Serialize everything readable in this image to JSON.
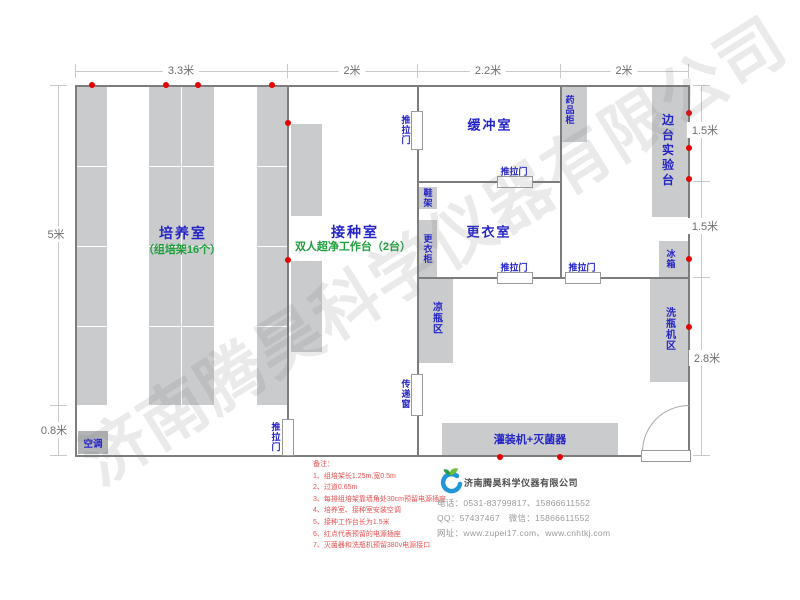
{
  "watermark": "济南腾昊科学仪器有限公司",
  "dims": {
    "top1": "3.3米",
    "top2": "2米",
    "top3": "2.2米",
    "top4": "2米",
    "left1": "5米",
    "left2": "0.8米",
    "right1": "1.5米",
    "right2": "1.5米",
    "right3": "2.8米"
  },
  "rooms": {
    "culture": "培养室",
    "culture_sub": "（组培架16个）",
    "inoculation": "接种室",
    "inoculation_sub": "双人超净工作台（2台）",
    "buffer": "缓冲室",
    "changing": "更衣室",
    "side_bench": "边台实验台"
  },
  "labels": {
    "sliding_door": "推拉门",
    "transfer_window": "传递窗",
    "ac": "空调",
    "medicine_cabinet": "药品柜",
    "shoe_rack": "鞋架",
    "wardrobe": "更衣柜",
    "fridge": "冰箱",
    "cool_bottle_area": "凉瓶区",
    "washer_area": "洗瓶机区",
    "filler": "灌装机+灭菌器"
  },
  "notes": {
    "title": "备注：",
    "items": [
      "1、组培架长1.25m,宽0.5m",
      "2、过道0.65m",
      "3、每排组培架靠墙角处30cm预留电源插座",
      "4、培养室、接种室安装空调",
      "5、接种工作台长为1.5米",
      "6、红点代表预留的电源插座",
      "7、灭菌器和洗瓶机预留380v电源接口"
    ]
  },
  "company": {
    "name": "济南腾昊科学仪器有限公司",
    "phone": "电话：0531-83799817、15866611552",
    "qq": "QQ：57437467　微信：15866611552",
    "web": "网址：www.zupei17.com、www.cnhtkj.com"
  },
  "sockets": [
    [
      92,
      85
    ],
    [
      166,
      85
    ],
    [
      198,
      85
    ],
    [
      272,
      85
    ],
    [
      288,
      123
    ],
    [
      288,
      260
    ],
    [
      689,
      113
    ],
    [
      689,
      148
    ],
    [
      689,
      179
    ],
    [
      689,
      259
    ],
    [
      689,
      327
    ],
    [
      500,
      457
    ],
    [
      560,
      457
    ]
  ],
  "colors": {
    "label_blue": "#2424c8",
    "sub_green": "#1ea03c",
    "note_red": "#e85050",
    "socket_red": "#e60000",
    "furniture_grey": "#cacbcd",
    "wall_grey": "#7d7d7d"
  }
}
